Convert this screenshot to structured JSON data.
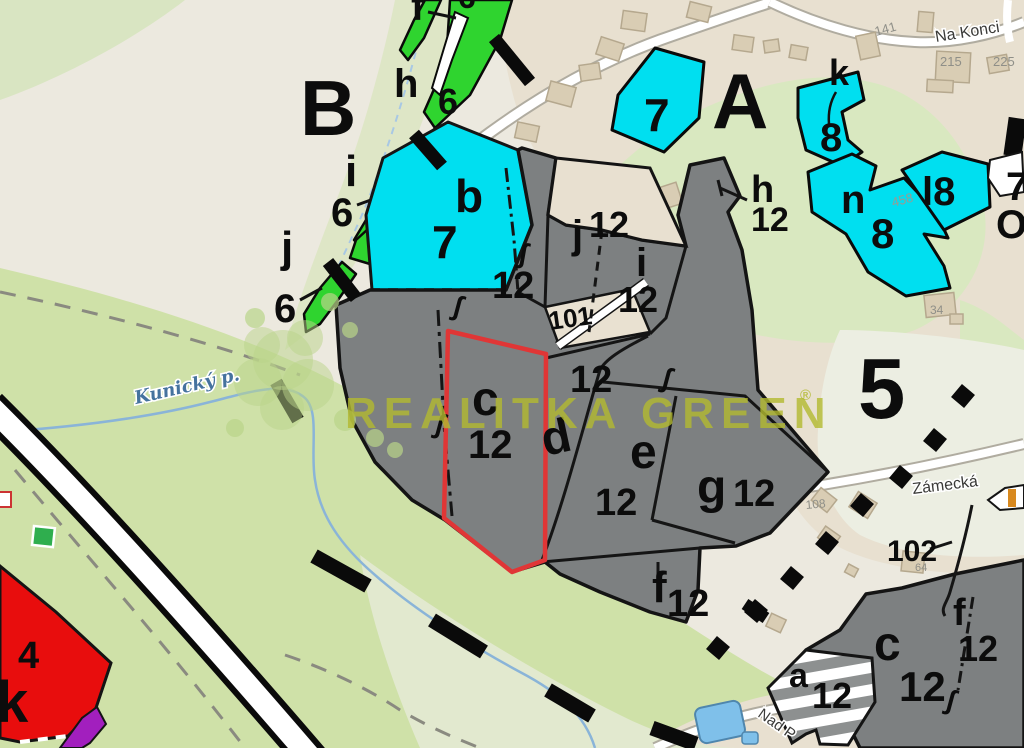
{
  "map": {
    "watermark": {
      "text": "REALITKA GREEN",
      "reg": "®"
    },
    "colors": {
      "parcel_gray": "#7d8081",
      "parcel_cyan": "#00dff0",
      "strip_green": "#2fd42f",
      "subject_outline_red": "#e03636",
      "zone_red": "#e80d0d",
      "zone_purple": "#a21fbe",
      "meadow_green": "#cfe1a8",
      "built_beige": "#e8e0d0",
      "water_blue": "#8ab4d8",
      "watermark_olive": "#b3ba30"
    },
    "labels": [
      {
        "n": "zone-letter-B",
        "t": "B",
        "x": 300,
        "y": 135,
        "s": 78
      },
      {
        "n": "zone-letter-A",
        "t": "A",
        "x": 712,
        "y": 128,
        "s": 78
      },
      {
        "n": "zone-number-5",
        "t": "5",
        "x": 858,
        "y": 418,
        "s": 85
      },
      {
        "n": "parcel-letter-h-top",
        "t": "h",
        "x": 394,
        "y": 97,
        "s": 40
      },
      {
        "n": "parcel-number-6-strip",
        "t": "6",
        "x": 438,
        "y": 114,
        "s": 36
      },
      {
        "n": "parcel-letter-i-left",
        "t": "i",
        "x": 345,
        "y": 186,
        "s": 44
      },
      {
        "n": "parcel-number-6-left",
        "t": "6",
        "x": 331,
        "y": 226,
        "s": 40
      },
      {
        "n": "parcel-letter-j-left",
        "t": "j",
        "x": 281,
        "y": 262,
        "s": 44
      },
      {
        "n": "parcel-number-6-lower",
        "t": "6",
        "x": 274,
        "y": 322,
        "s": 40
      },
      {
        "n": "parcel-letter-f-topcut",
        "t": "f",
        "x": 411,
        "y": 20,
        "s": 40
      },
      {
        "n": "parcel-number-6-topcut",
        "t": "6",
        "x": 458,
        "y": 8,
        "s": 32
      },
      {
        "n": "parcel-letter-b",
        "t": "b",
        "x": 455,
        "y": 212,
        "s": 46
      },
      {
        "n": "parcel-number-7-b",
        "t": "7",
        "x": 432,
        "y": 258,
        "s": 46
      },
      {
        "n": "parcel-number-7-top",
        "t": "7",
        "x": 644,
        "y": 131,
        "s": 46
      },
      {
        "n": "parcel-letter-k-cyan",
        "t": "k",
        "x": 829,
        "y": 85,
        "s": 36
      },
      {
        "n": "parcel-number-8-k",
        "t": "8",
        "x": 820,
        "y": 151,
        "s": 40
      },
      {
        "n": "parcel-letter-n-cyan",
        "t": "n",
        "x": 841,
        "y": 213,
        "s": 40
      },
      {
        "n": "parcel-number-8-n",
        "t": "8",
        "x": 871,
        "y": 248,
        "s": 42
      },
      {
        "n": "parcel-label-l8",
        "t": "l8",
        "x": 922,
        "y": 205,
        "s": 40
      },
      {
        "n": "parcel-letter-h12",
        "t": "h",
        "x": 751,
        "y": 202,
        "s": 38
      },
      {
        "n": "parcel-number-12-h",
        "t": "12",
        "x": 751,
        "y": 231,
        "s": 34
      },
      {
        "n": "parcel-letter-j12",
        "t": "j",
        "x": 572,
        "y": 248,
        "s": 40
      },
      {
        "n": "parcel-number-12-j",
        "t": "12",
        "x": 589,
        "y": 237,
        "s": 36
      },
      {
        "n": "parcel-letter-i12",
        "t": "i",
        "x": 636,
        "y": 276,
        "s": 40
      },
      {
        "n": "parcel-number-12-i",
        "t": "12",
        "x": 618,
        "y": 312,
        "s": 36
      },
      {
        "n": "parcel-number-12-s",
        "t": "12",
        "x": 492,
        "y": 298,
        "s": 38
      },
      {
        "n": "parcel-number-101",
        "t": "101",
        "x": 550,
        "y": 330,
        "s": 26,
        "r": -8
      },
      {
        "n": "parcel-number-12-d",
        "t": "12",
        "x": 570,
        "y": 392,
        "s": 38
      },
      {
        "n": "parcel-letter-d",
        "t": "d",
        "x": 545,
        "y": 456,
        "s": 48,
        "r": -12
      },
      {
        "n": "parcel-letter-e",
        "t": "e",
        "x": 630,
        "y": 468,
        "s": 48
      },
      {
        "n": "parcel-number-12-e",
        "t": "12",
        "x": 595,
        "y": 515,
        "s": 38
      },
      {
        "n": "parcel-letter-g",
        "t": "g",
        "x": 697,
        "y": 503,
        "s": 48
      },
      {
        "n": "parcel-number-12-g",
        "t": "12",
        "x": 733,
        "y": 506,
        "s": 38
      },
      {
        "n": "subject-parcel-letter-c",
        "t": "c",
        "x": 472,
        "y": 415,
        "s": 48
      },
      {
        "n": "subject-parcel-number-12",
        "t": "12",
        "x": 468,
        "y": 458,
        "s": 40
      },
      {
        "n": "parcel-letter-f-mid",
        "t": "f",
        "x": 652,
        "y": 602,
        "s": 44
      },
      {
        "n": "parcel-number-12-f",
        "t": "12",
        "x": 667,
        "y": 616,
        "s": 38
      },
      {
        "n": "parcel-number-102",
        "t": "102",
        "x": 887,
        "y": 561,
        "s": 30
      },
      {
        "n": "parcel-letter-c-br",
        "t": "c",
        "x": 874,
        "y": 660,
        "s": 48
      },
      {
        "n": "parcel-number-12-cbr",
        "t": "12",
        "x": 899,
        "y": 701,
        "s": 42
      },
      {
        "n": "parcel-letter-f-br",
        "t": "f",
        "x": 953,
        "y": 625,
        "s": 38
      },
      {
        "n": "parcel-number-12-fbr",
        "t": "12",
        "x": 958,
        "y": 661,
        "s": 36
      },
      {
        "n": "parcel-letter-a",
        "t": "a",
        "x": 789,
        "y": 687,
        "s": 34
      },
      {
        "n": "parcel-number-12-a",
        "t": "12",
        "x": 812,
        "y": 708,
        "s": 36
      },
      {
        "n": "zone-number-4",
        "t": "4",
        "x": 18,
        "y": 668,
        "s": 38
      },
      {
        "n": "zone-letter-k",
        "t": "k",
        "x": -4,
        "y": 722,
        "s": 58
      },
      {
        "n": "parcel-number-7-cut",
        "t": "7",
        "x": 1006,
        "y": 200,
        "s": 40
      },
      {
        "n": "parcel-label-oz-cut",
        "t": "Oz",
        "x": 996,
        "y": 238,
        "s": 40
      },
      {
        "n": "house-number-141",
        "t": "141",
        "x": 876,
        "y": 36,
        "s": 13,
        "r": -15,
        "c": "#8f8f88",
        "w": "normal"
      },
      {
        "n": "house-number-215",
        "t": "215",
        "x": 940,
        "y": 66,
        "s": 13,
        "c": "#8f8f88",
        "w": "normal"
      },
      {
        "n": "house-number-225",
        "t": "225",
        "x": 993,
        "y": 66,
        "s": 13,
        "c": "#8f8f88",
        "w": "normal"
      },
      {
        "n": "house-number-34",
        "t": "34",
        "x": 930,
        "y": 314,
        "s": 12,
        "c": "#8f8f88",
        "w": "normal"
      },
      {
        "n": "house-number-458",
        "t": "458",
        "x": 893,
        "y": 207,
        "s": 13,
        "r": -15,
        "c": "#9a9a92",
        "w": "normal"
      },
      {
        "n": "house-number-108",
        "t": "108",
        "x": 806,
        "y": 509,
        "s": 12,
        "r": -5,
        "c": "#8f8f88",
        "w": "normal"
      },
      {
        "n": "house-number-64",
        "t": "64",
        "x": 915,
        "y": 571,
        "s": 11,
        "c": "#8f8f88",
        "w": "normal"
      },
      {
        "n": "street-label-na-konci",
        "t": "Na Konci",
        "x": 936,
        "y": 42,
        "s": 16,
        "r": -9,
        "c": "#3a3a38",
        "halo": true,
        "w": "normal"
      },
      {
        "n": "street-label-zamecka",
        "t": "Zámecká",
        "x": 913,
        "y": 494,
        "s": 16,
        "r": -7,
        "c": "#3a3a38",
        "halo": true,
        "w": "normal"
      },
      {
        "n": "street-label-nad-p",
        "t": "Nad P",
        "x": 757,
        "y": 716,
        "s": 15,
        "r": 35,
        "c": "#3a3a38",
        "halo": true,
        "w": "normal"
      },
      {
        "n": "stream-label-kunicky",
        "t": "Kunický p.",
        "x": 136,
        "y": 404,
        "s": 18,
        "r": -13,
        "c": "#45729e",
        "i": true,
        "f": "serif",
        "halo": true,
        "w": "bold"
      },
      {
        "n": "map-symbol-s1",
        "t": "∫",
        "x": 518,
        "y": 262,
        "s": 28,
        "r": 10
      },
      {
        "n": "map-symbol-s2",
        "t": "∫",
        "x": 452,
        "y": 314,
        "s": 28,
        "r": 15
      },
      {
        "n": "map-symbol-s3",
        "t": "∫",
        "x": 434,
        "y": 432,
        "s": 28,
        "r": 15
      },
      {
        "n": "map-symbol-s4",
        "t": "∫",
        "x": 661,
        "y": 386,
        "s": 28,
        "r": 15
      },
      {
        "n": "map-symbol-s5",
        "t": "∫",
        "x": 945,
        "y": 708,
        "s": 28,
        "r": 15
      },
      {
        "n": "watermark-brand",
        "t": "REALITKA GREEN",
        "x": 345,
        "y": 428,
        "s": 44,
        "ls": 7,
        "c": "#b3ba30",
        "o": 0.8
      },
      {
        "n": "watermark-registered",
        "t": "®",
        "x": 800,
        "y": 400,
        "s": 15,
        "c": "#b3ba30",
        "o": 0.8
      }
    ]
  }
}
